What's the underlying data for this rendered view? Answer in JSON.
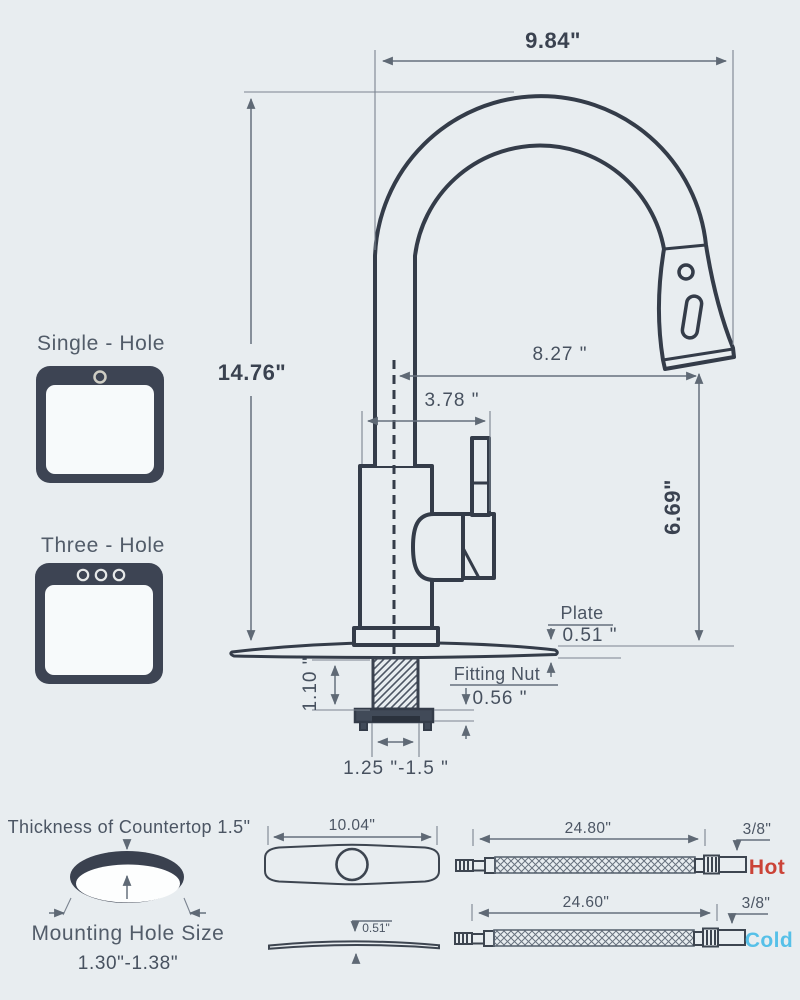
{
  "faucet_diagram": {
    "spout_width": "9.84\"",
    "total_height": "14.76\"",
    "spout_reach": "8.27 \"",
    "handle_reach": "3.78 \"",
    "spout_height": "6.69\"",
    "plate": {
      "label": "Plate",
      "thickness": "0.51 \""
    },
    "fitting_nut": {
      "label": "Fitting Nut",
      "height": "0.56 \""
    },
    "shank_height": "1.10 \"",
    "mounting_hole_range": "1.25 \"-1.5 \""
  },
  "installation_options": {
    "single_hole_label": "Single - Hole",
    "three_hole_label": "Three - Hole"
  },
  "countertop": {
    "thickness_label": "Thickness of Countertop 1.5\"",
    "mounting_hole_label": "Mounting Hole Size",
    "mounting_hole_range": "1.30\"-1.38\""
  },
  "deck_plate": {
    "width": "10.04\"",
    "thickness": "0.51\""
  },
  "supply_hoses": {
    "hot": {
      "length": "24.80\"",
      "connector_size": "3/8\"",
      "label": "Hot",
      "color": "#cb4337"
    },
    "cold": {
      "length": "24.60\"",
      "connector_size": "3/8\"",
      "label": "Cold",
      "color": "#56c0e8"
    }
  },
  "colors": {
    "background": "#e8edf0",
    "line": "#343c49",
    "dimension": "#66707d",
    "icon_fill": "#3d4453"
  }
}
